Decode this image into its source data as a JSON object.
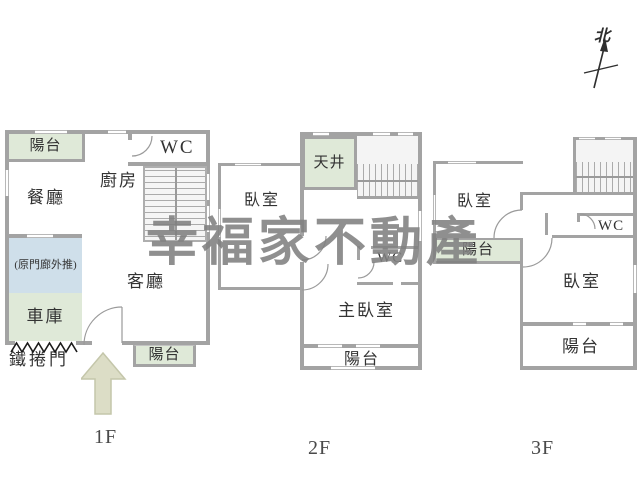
{
  "watermark": "幸福家不動產",
  "compass": {
    "label": "北"
  },
  "colors": {
    "wall": "#a3a3a3",
    "balcony_green": "#dfe9d8",
    "porch_blue": "#cfdfea",
    "stair_bg": "#f5f5f5",
    "arrow_beige": "#dcddc6",
    "watermark_gray": "#8a8a8a"
  },
  "floors": [
    {
      "label": "1F",
      "rooms": {
        "balcony_top": "陽台",
        "dining": "餐廳",
        "kitchen": "廚房",
        "wc": "WC",
        "living": "客廳",
        "porch": "(原門廊外推)",
        "garage": "車庫",
        "roller_door": "鐵捲門",
        "balcony_bottom": "陽台"
      }
    },
    {
      "label": "2F",
      "rooms": {
        "lightwell": "天井",
        "bedroom": "臥室",
        "wc": "WC",
        "master_bedroom": "主臥室",
        "balcony_bottom": "陽台"
      }
    },
    {
      "label": "3F",
      "rooms": {
        "bedroom_left": "臥室",
        "balcony_left": "陽台",
        "wc": "WC",
        "bedroom_right": "臥室",
        "balcony_bottom": "陽台"
      }
    }
  ]
}
